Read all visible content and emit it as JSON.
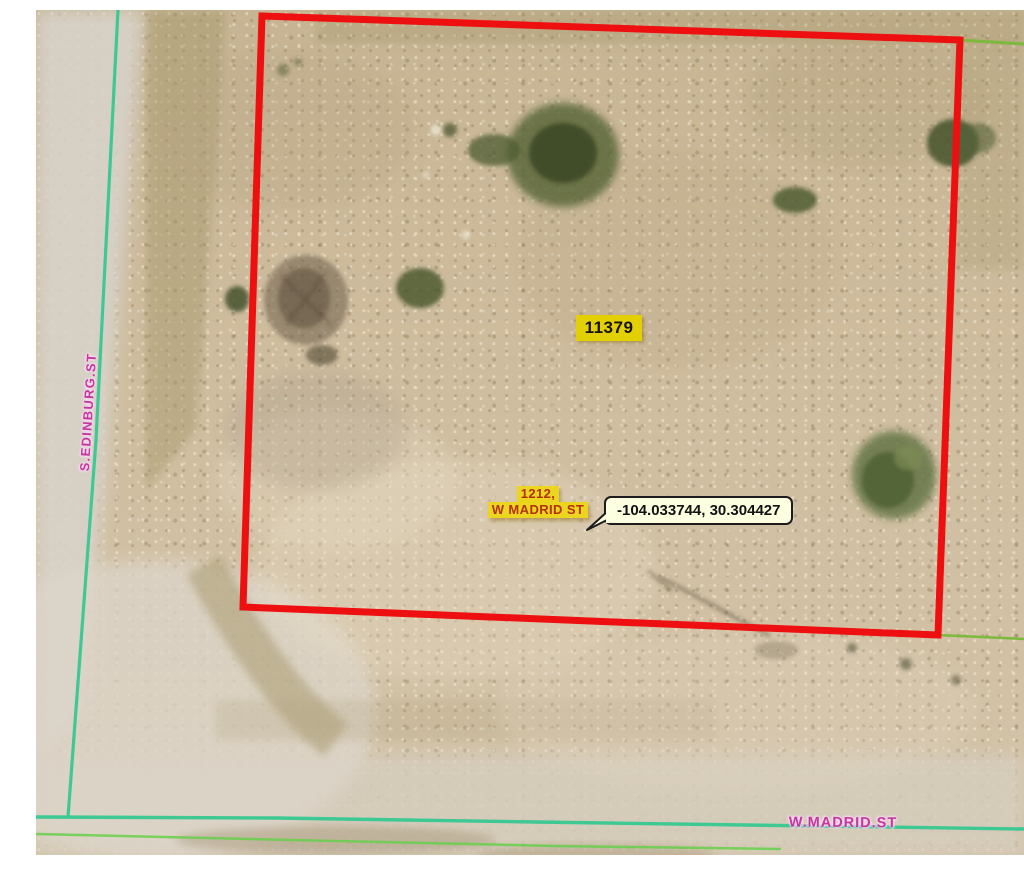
{
  "map": {
    "parcel": {
      "id_label": "11379"
    },
    "address_label": {
      "line1": "1212,",
      "line2": "W MADRID ST"
    },
    "tooltip": {
      "coordinates": "-104.033744, 30.304427"
    },
    "streets": {
      "left": "S.EDINBURG.ST",
      "bottom": "W.MADRID.ST"
    },
    "colors": {
      "parcel_outline": "#ee1010",
      "street_centerline_teal": "#35c791",
      "boundary_line_green": "#7cb93e",
      "secondary_line_green": "#67cf4b",
      "label_highlight_yellow": "#e2cf04",
      "address_highlight_yellow": "#ecd51e",
      "address_text_red": "#b23108",
      "street_text_magenta": "#bf3a9c",
      "tooltip_background": "#fdffe1",
      "tooltip_border": "#1c1c1c"
    }
  }
}
